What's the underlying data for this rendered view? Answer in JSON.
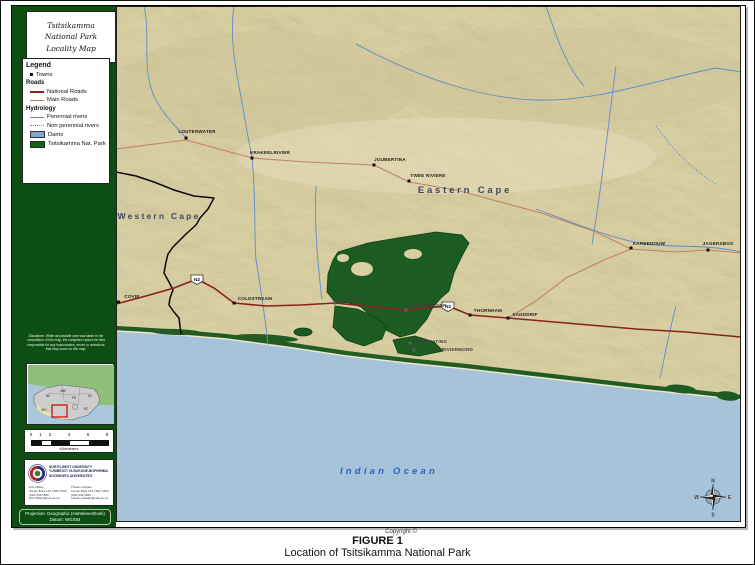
{
  "title_box": {
    "lines": [
      "Tsitsikamma",
      "National Park",
      "Locality Map"
    ]
  },
  "legend": {
    "title": "Legend",
    "items": {
      "towns": "Towns",
      "roads_header": "Roads",
      "national_roads": "National Roads",
      "main_roads": "Main Roads",
      "hydrology_header": "Hydrology",
      "perennial_rivers": "Perennial rivers",
      "non_perennial_rivers": "Non perennial rivers",
      "dams": "Dams",
      "park": "Tsitsikamma Nat. Park"
    }
  },
  "disclaimer": {
    "text": "Disclaimer: While all possible care was taken in the compilation of this map, the compilers cannot be held responsible for any inaccuracies, errors or omissions that may occur on this map."
  },
  "inset": {
    "provinces": [
      "NC",
      "NW",
      "FS",
      "KZ",
      "EC",
      "WC"
    ]
  },
  "scalebar": {
    "ticks": [
      "0",
      "1",
      "2",
      "4",
      "6",
      "8"
    ],
    "unit": "Kilometers"
  },
  "university": {
    "name_lines": [
      "NORTH-WEST UNIVERSITY",
      "YUNIBESITI YA BOKONE-BOPHIRIMA",
      "NOORDWES-UNIVERSITEIT"
    ],
    "contact_left": [
      "Dirk Cilliers",
      "Interne Boks 123, NWU 2520",
      "(018) 299 1589",
      "Dirk.Cilliers@nwu.ac.za"
    ],
    "contact_right": [
      "Theuns Jordaan",
      "Interne Boks 123, NWU 2520",
      "(018) 299 1582",
      "Theuns.Jordaan@nwu.ac.za"
    ]
  },
  "projection": {
    "lines": [
      "Projection: Geographic (Hartebeesthoek)",
      "Datum: WGS84"
    ]
  },
  "map_labels": {
    "western_cape": "Western Cape",
    "eastern_cape": "Eastern Cape",
    "indian_ocean": "Indian Ocean",
    "n2": "N2"
  },
  "towns": [
    {
      "name": "LOUTERWATER"
    },
    {
      "name": "KRAKEELRIVIER"
    },
    {
      "name": "JOUBERTINA"
    },
    {
      "name": "TWEE RIVIERE"
    },
    {
      "name": "KAREEDOUW"
    },
    {
      "name": "JAGERSBOS"
    },
    {
      "name": "COVIE"
    },
    {
      "name": "COLDSTREAM"
    },
    {
      "name": "KLEINBOS"
    },
    {
      "name": "STORMSRIVIER"
    },
    {
      "name": "THORNHAM"
    },
    {
      "name": "SANDDRIF"
    },
    {
      "name": "MARE KATING"
    },
    {
      "name": "STORMSRIVIERMOND"
    }
  ],
  "compass": {
    "n": "N",
    "e": "E",
    "s": "S",
    "w": "W"
  },
  "copyright": {
    "text": "Copyright ©"
  },
  "caption": {
    "line1": "FIGURE 1",
    "line2": "Location of Tsitsikamma National Park"
  },
  "colors": {
    "sidebar_green": "#0d4f12",
    "park_green": "#1d5c21",
    "ocean_blue": "#a7c3d9",
    "terrain_beige": "#d8cfa2",
    "national_road": "#8b2020",
    "main_road": "#c4826a",
    "river_blue": "#5f8ec9"
  }
}
